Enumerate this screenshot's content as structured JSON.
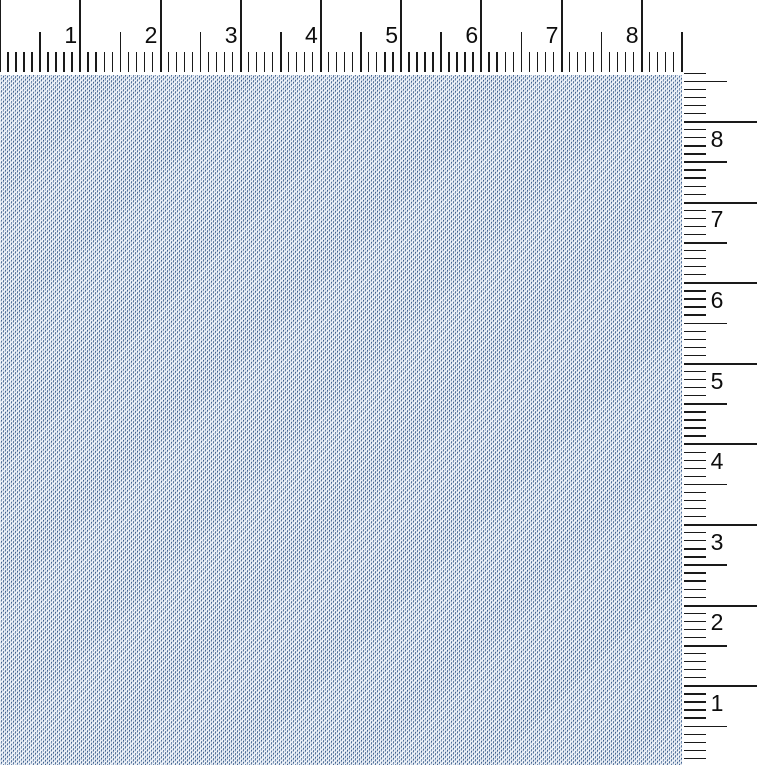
{
  "canvas": {
    "width_px": 757,
    "height_px": 765
  },
  "fabric": {
    "description": "light blue twill-weave fabric swatch",
    "base_color": "#eef3f9",
    "thread_dark_color": "#42628e",
    "thread_light_color": "#8ba3c3",
    "weave_direction": "diagonal-up-right"
  },
  "rulers": {
    "tick_color": "#1a1a1a",
    "label_color": "#0d0d0d",
    "units": "inches",
    "horizontal": {
      "position": "top",
      "labels": [
        "1",
        "2",
        "3",
        "4",
        "5",
        "6",
        "7",
        "8"
      ],
      "pixels_per_inch": 80.2,
      "minor_divisions_per_inch": 10,
      "extent_inches": 8.5
    },
    "vertical": {
      "position": "right",
      "labels_top_to_bottom": [
        "8",
        "7",
        "6",
        "5",
        "4",
        "3",
        "2",
        "1"
      ],
      "pixels_per_inch": 80.6,
      "minor_divisions_per_inch": 10,
      "extent_inches": 8.6,
      "origin": "bottom-edge",
      "origin_y_px": 766.6
    }
  }
}
